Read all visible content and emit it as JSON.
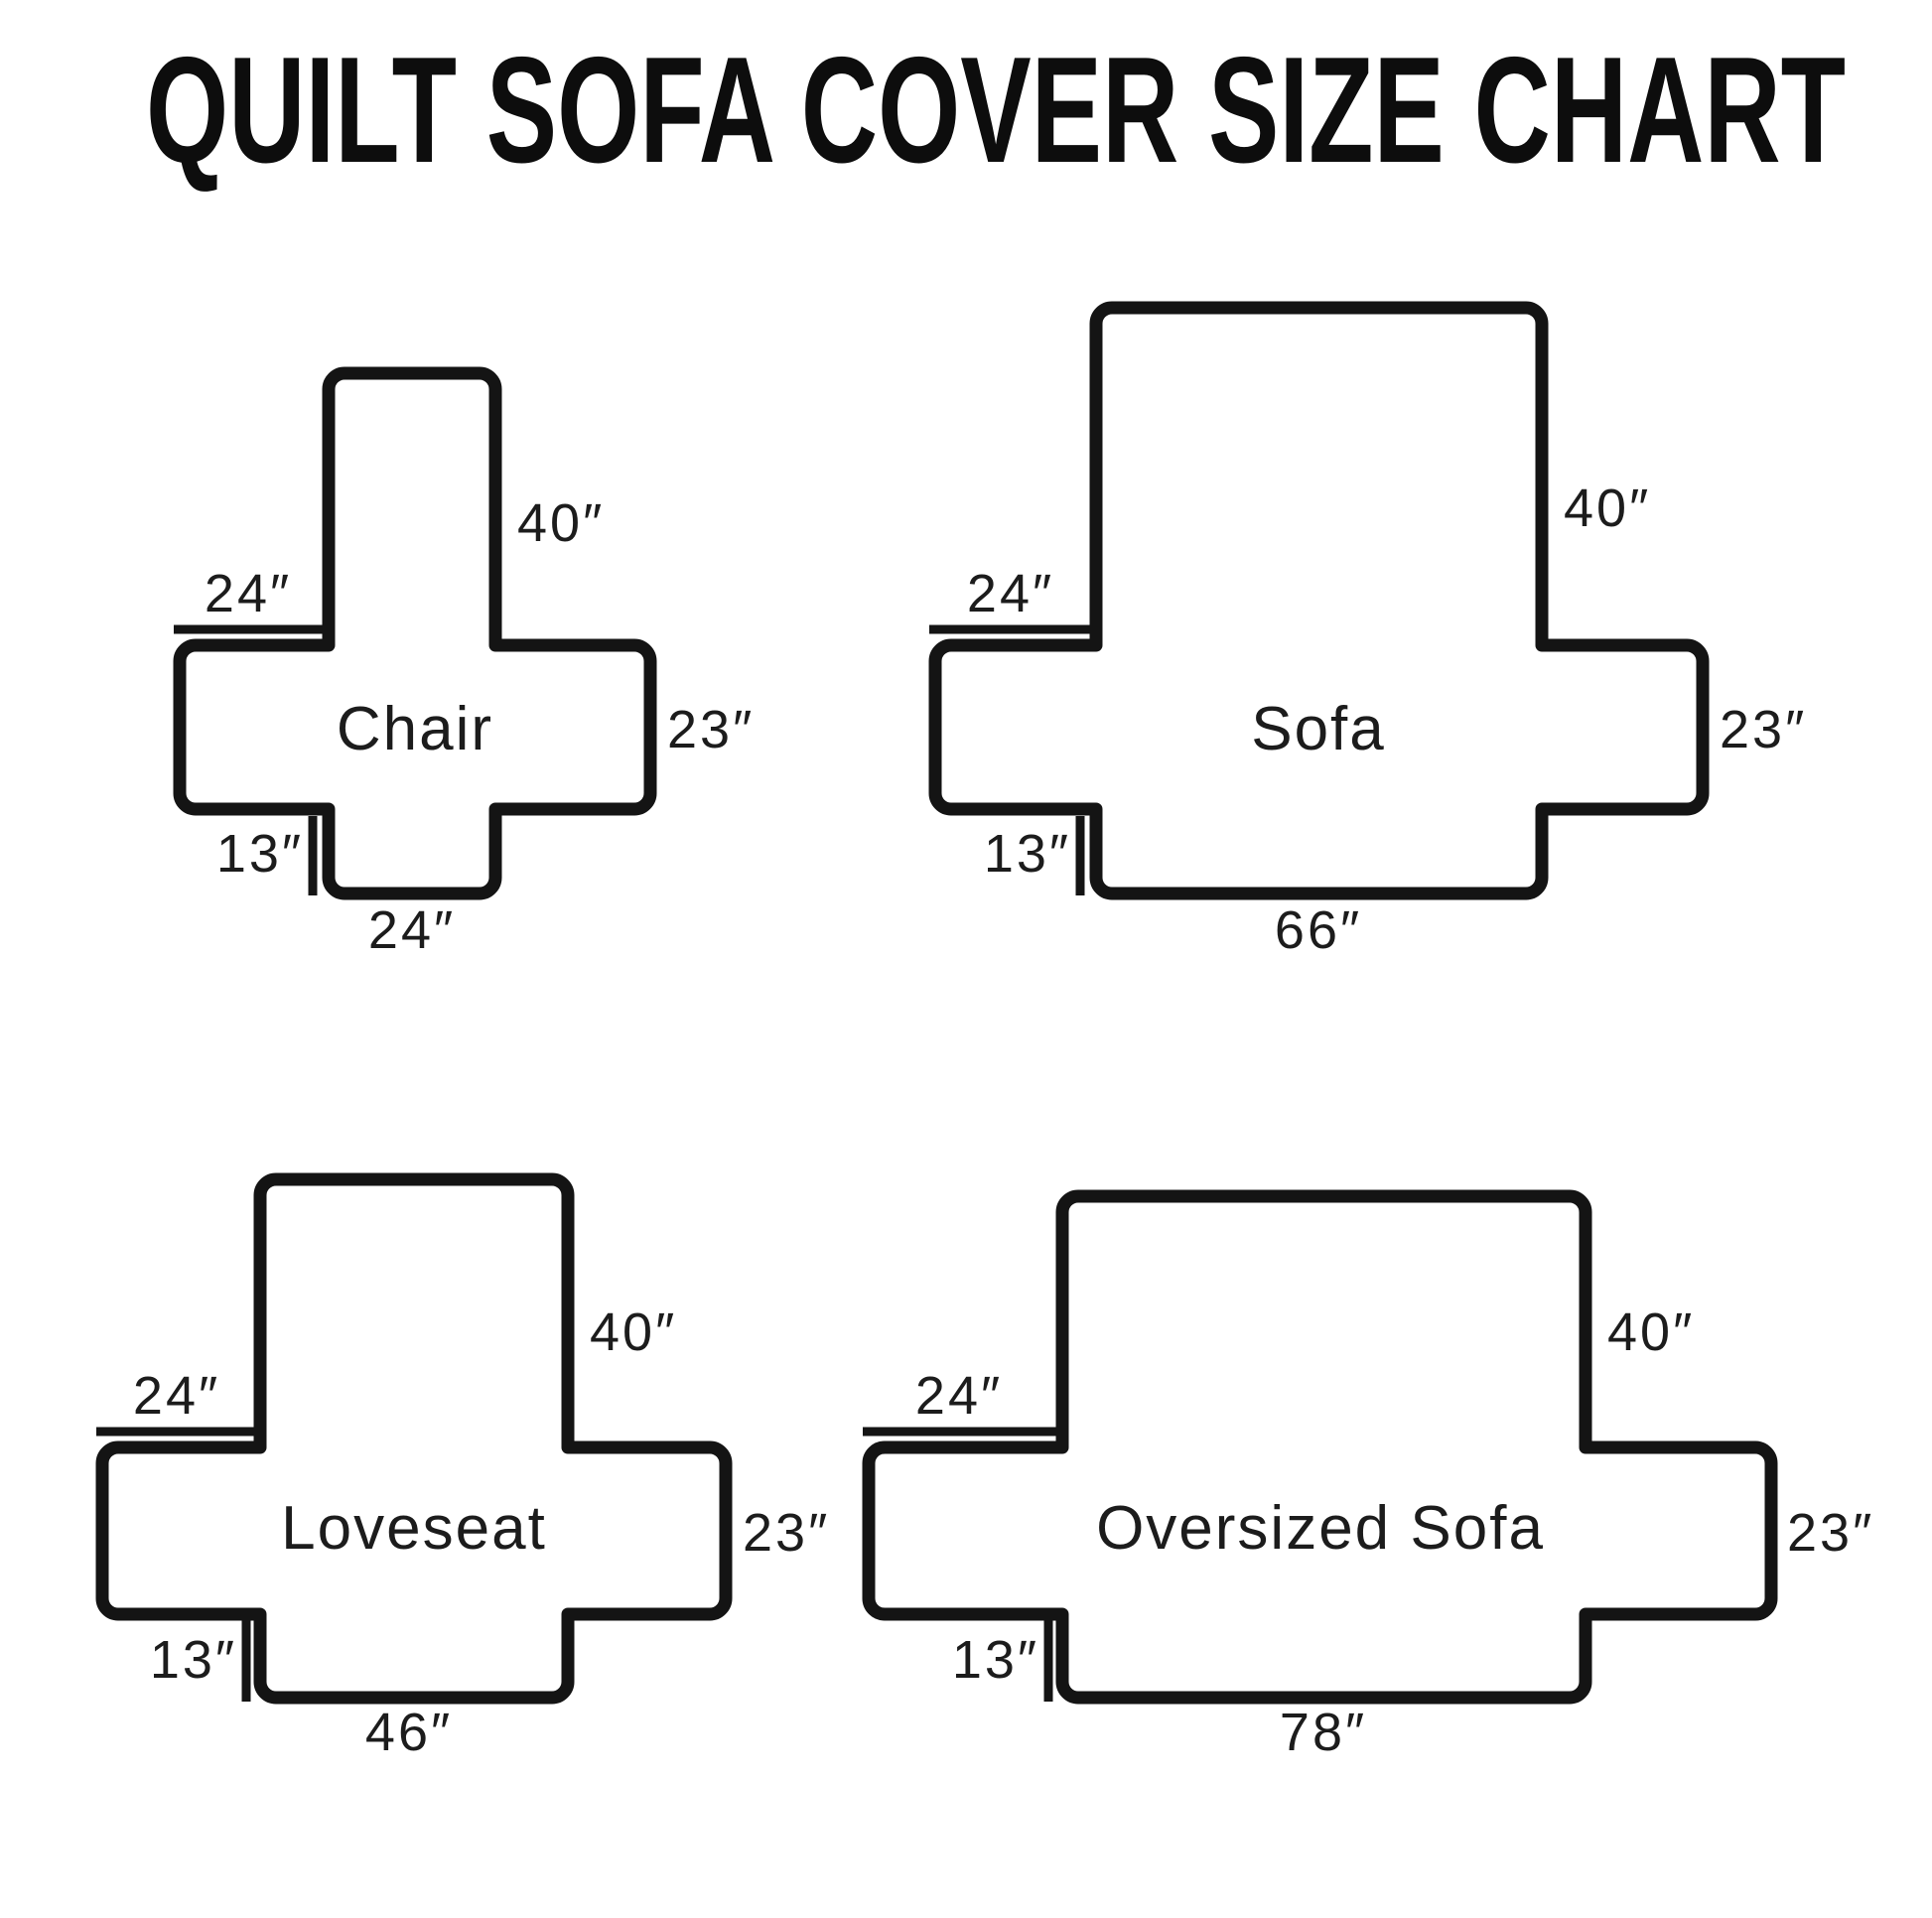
{
  "title": "QUILT SOFA COVER SIZE CHART",
  "diagrams": [
    {
      "name": "Chair",
      "arm_top_width": "24″",
      "back_height": "40″",
      "seat_side_depth": "23″",
      "front_drop": "13″",
      "bottom_width": "24″"
    },
    {
      "name": "Sofa",
      "arm_top_width": "24″",
      "back_height": "40″",
      "seat_side_depth": "23″",
      "front_drop": "13″",
      "bottom_width": "66″"
    },
    {
      "name": "Loveseat",
      "arm_top_width": "24″",
      "back_height": "40″",
      "seat_side_depth": "23″",
      "front_drop": "13″",
      "bottom_width": "46″"
    },
    {
      "name": "Oversized Sofa",
      "arm_top_width": "24″",
      "back_height": "40″",
      "seat_side_depth": "23″",
      "front_drop": "13″",
      "bottom_width": "78″"
    }
  ]
}
